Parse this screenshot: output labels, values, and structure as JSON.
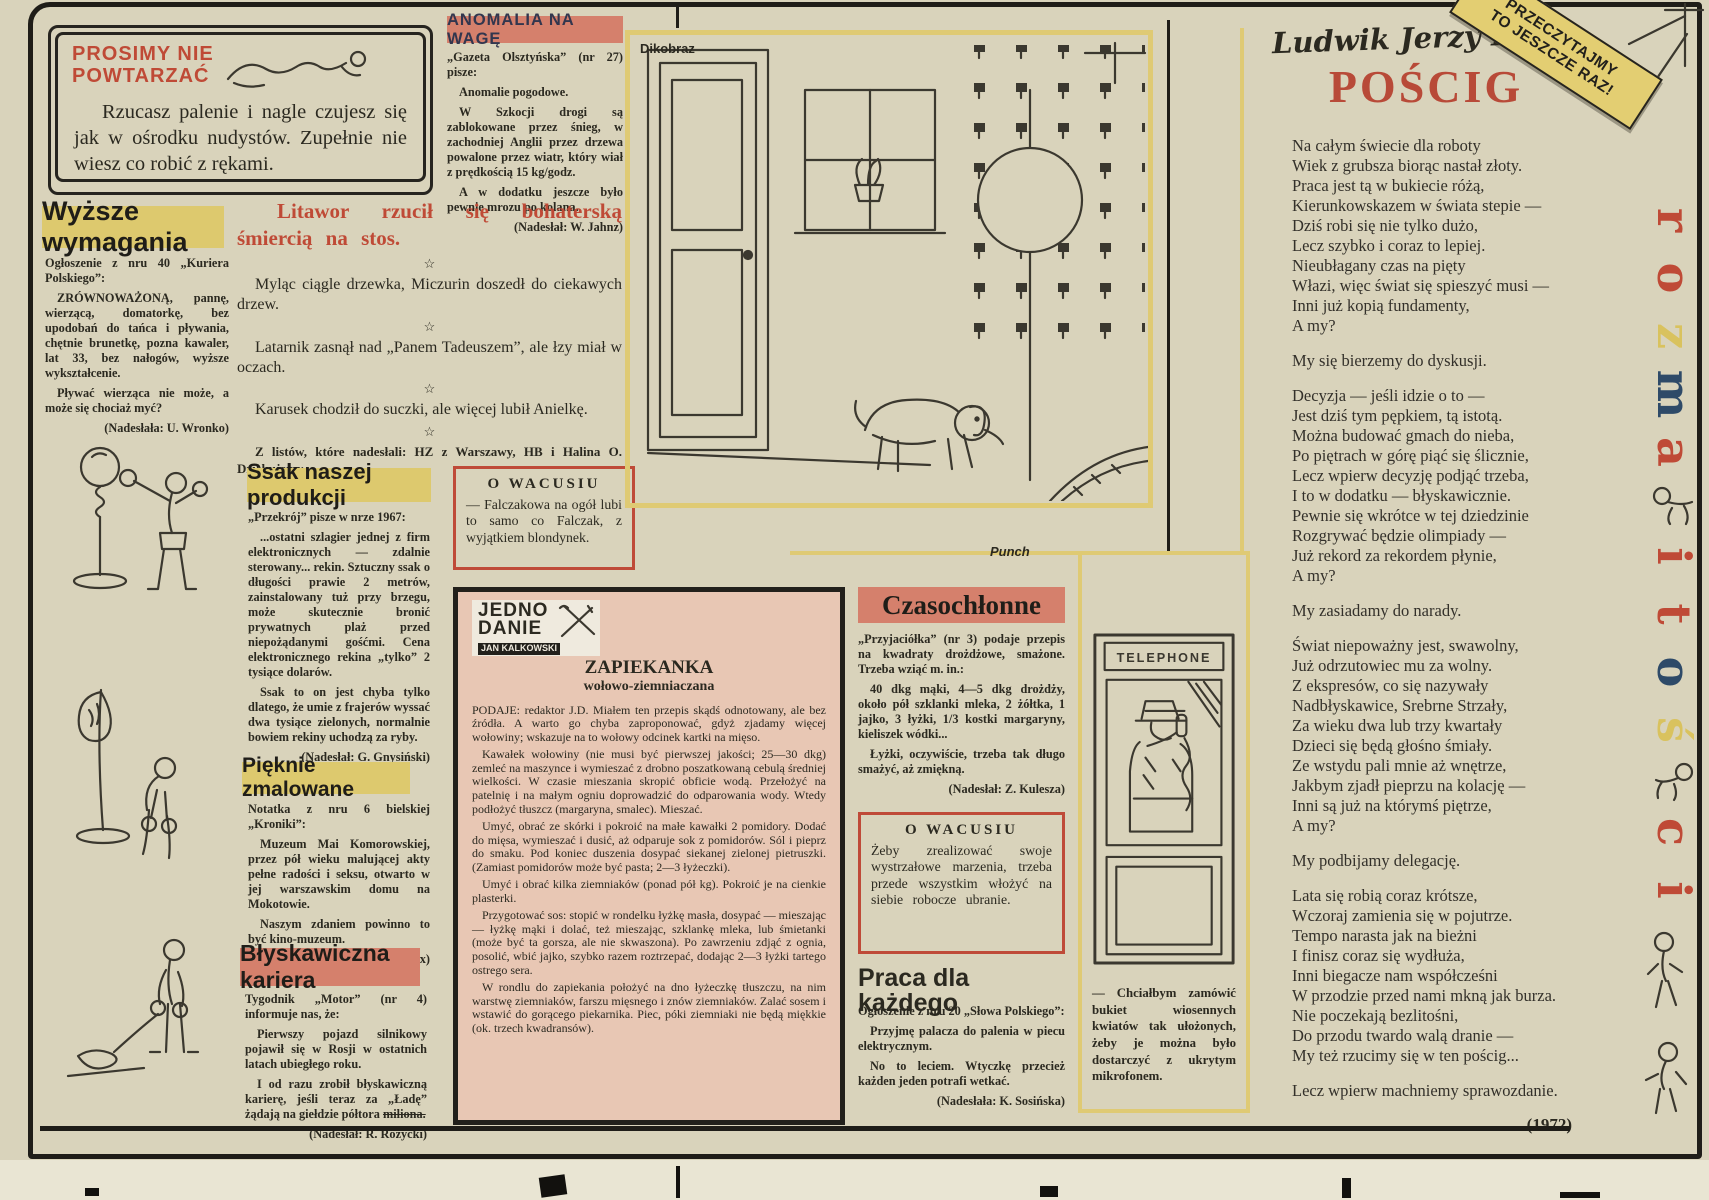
{
  "palette": {
    "paper": "#d9d3bb",
    "ink": "#2b2920",
    "accent_red": "#bf4a36",
    "poem_red": "#b84a38",
    "headline_salmon": "#d5806c",
    "highlight_yellow": "#ddc96e",
    "recipe_pink": "#e8c7b4",
    "navy": "#32364e",
    "frame_yellow": "#dfca74"
  },
  "corner_banner": {
    "text": "PRZECZYTAJMY\nTO JESZCZE RAZ!"
  },
  "no_repeat_box": {
    "title": "PROSIMY NIE\nPOWTARZAĆ",
    "body": "Rzucasz palenie i nagle czujesz się jak w ośrodku nudystów. Zupełnie nie wiesz co robić z rękami."
  },
  "wyzsze_wymagania": {
    "title": "Wyższe wymagania",
    "paragraphs": [
      "Ogłoszenie z nru 40 „Kuriera Polskiego”:",
      "ZRÓWNOWAŻONĄ, pannę, wierzącą, domatorkę, bez upodobań do tańca i pływania, chętnie brunetkę, pozna kawaler, lat 33, bez nałogów, wyższe wykształcenie.",
      "Pływać wierząca nie może, a może się chociaż myć?"
    ],
    "credit": "(Nadesłała: U. Wronko)"
  },
  "anomalia": {
    "title": "ANOMALIA NA WAGĘ",
    "paragraphs": [
      "„Gazeta Olsztyńska” (nr 27) pisze:",
      "Anomalie pogodowe.",
      "W Szkocji drogi są zablokowane przez śnieg, w zachodniej Anglii przez drzewa powalone przez wiatr, który wiał z prędkością 15 kg/godz.",
      "A w dodatku jeszcze było pewnie mrozu po kolana."
    ],
    "credit": "(Nadesłał: W. Jahnz)"
  },
  "litawor": {
    "headline": "Litawor rzucił się bohaterską śmiercią na stos.",
    "star": "☆",
    "aphorisms": [
      "Myląc ciągle drzewka, Miczurin doszedł do ciekawych drzew.",
      "Latarnik zasnął nad „Panem Tadeuszem”, ale łzy miał w oczach.",
      "Karusek chodził do suczki, ale więcej lubił Anielkę."
    ],
    "letters_note": "Z listów, które nadesłali: HZ z Warszawy, HB i Halina O. Dziękujemy."
  },
  "ssak": {
    "title": "Ssak naszej produkcji",
    "paragraphs": [
      "„Przekrój” pisze w nrze 1967:",
      "...ostatni szlagier jednej z firm elektronicznych — zdalnie sterowany... rekin. Sztuczny ssak o długości prawie 2 metrów, zainstalowany tuż przy brzegu, może skutecznie bronić prywatnych plaż przed niepożądanymi gośćmi. Cena elektronicznego rekina „tylko” 2 tysiące dolarów.",
      "Ssak to on jest chyba tylko dlatego, że umie z frajerów wyssać dwa tysiące zielonych, normalnie bowiem rekiny uchodzą za ryby."
    ],
    "credit": "(Nadesłał: G. Gnysiński)"
  },
  "pieknie": {
    "title": "Pięknie zmalowane",
    "paragraphs": [
      "Notatka z nru 6 bielskiej „Kroniki”:",
      "Muzeum Mai Komorowskiej, przez pół wieku malującej akty pełne radości i seksu, otwarto w jej warszawskim domu na Mokotowie.",
      "Naszym zdaniem powinno to być kino-muzeum."
    ],
    "credit": "(Nadesłał: W. Fox)"
  },
  "blyskawiczna": {
    "title": "Błyskawiczna kariera",
    "paragraphs": [
      "Tygodnik „Motor” (nr 4) informuje nas, że:",
      "Pierwszy pojazd silnikowy pojawił się w Rosji w ostatnich latach ubiegłego roku.",
      "I od razu zrobił błyskawiczną karierę, jeśli teraz za „Ładę” żądają na giełdzie półtora"
    ],
    "strike_word": "miliona.",
    "credit": "(Nadesłał: R. Różycki)"
  },
  "wacusiu1": {
    "title": "O WACUSIU",
    "body": "— Falczakowa na ogół lubi to samo co Falczak, z wyjątkiem blondynek."
  },
  "zapiekanka": {
    "logo_line1": "JEDNO",
    "logo_line2": "DANIE",
    "logo_byline": "JAN KALKOWSKI",
    "title": "ZAPIEKANKA",
    "subtitle": "wołowo-ziemniaczana",
    "paragraphs": [
      "PODAJE: redaktor J.D. Miałem ten przepis skądś odnotowany, ale bez źródła. A warto go chyba zaproponować, gdyż zjadamy więcej wołowiny; wskazuje na to wołowy odcinek kartki na mięso.",
      "Kawałek wołowiny (nie musi być pierwszej jakości; 25—30 dkg) zemleć na maszynce i wymieszać z drobno poszatkowaną cebulą średniej wielkości. W czasie mieszania skropić obficie wodą. Przełożyć na patelnię i na małym ogniu doprowadzić do odparowania wody. Wtedy podłożyć tłuszcz (margaryna, smalec). Mieszać.",
      "Umyć, obrać ze skórki i pokroić na małe kawałki 2 pomidory. Dodać do mięsa, wymieszać i dusić, aż odparuje sok z pomidorów. Sól i pieprz do smaku. Pod koniec duszenia dosypać siekanej zielonej pietruszki. (Zamiast pomidorów może być pasta; 2—3 łyżeczki).",
      "Umyć i obrać kilka ziemniaków (ponad pół kg). Pokroić je na cienkie plasterki.",
      "Przygotować sos: stopić w rondelku łyżkę masła, dosypać — mieszając — łyżkę mąki i dolać, też mieszając, szklankę mleka, lub śmietanki (może być ta gorsza, ale nie skwaszona). Po zawrzeniu zdjąć z ognia, posolić, wbić jajko, szybko razem roztrzepać, dodając 2—3 łyżki tartego ostrego sera.",
      "W rondlu do zapiekania położyć na dno łyżeczkę tłuszczu, na nim warstwę ziemniaków, farszu mięsnego i znów ziemniaków. Zalać sosem i wstawić do gorącego piekarnika. Piec, póki ziemniaki nie będą miękkie (ok. trzech kwadransów)."
    ]
  },
  "czasochlonne": {
    "title": "Czasochłonne",
    "paragraphs": [
      "„Przyjaciółka” (nr 3) podaje przepis na kwadraty drożdżowe, smażone. Trzeba wziąć m. in.:",
      "40 dkg mąki, 4—5 dkg drożdży, około pół szklanki mleka, 2 żółtka, 1 jajko, 3 łyżki, 1/3 kostki margaryny, kieliszek wódki...",
      "Łyżki, oczywiście, trzeba tak długo smażyć, aż zmiękną."
    ],
    "credit": "(Nadesłał: Z. Kulesza)"
  },
  "wacusiu2": {
    "title": "O WACUSIU",
    "body": "Żeby zrealizować swoje wystrzałowe marzenia, trzeba przede wszystkim włożyć na siebie robocze ubranie."
  },
  "praca": {
    "title": "Praca dla każdego",
    "paragraphs": [
      "Ogłoszenie z nru 20 „Słowa Polskiego”:",
      "Przyjmę palacza do palenia w piecu elektrycznym.",
      "No to leciem. Wtyczkę przecież każden jeden potrafi wetkać."
    ],
    "credit": "(Nadesłała: K. Sosińska)"
  },
  "dikobraz": {
    "label": "Dikobraz"
  },
  "punch": {
    "label": "Punch",
    "sign": "TELEPHONE",
    "caption": "— Chciałbym zamówić bukiet wiosennych kwiatów tak ułożonych, żeby je można było dostarczyć z ukrytym mikrofonem."
  },
  "poem": {
    "author": "Ludwik Jerzy Kern",
    "title": "POŚCIG",
    "stanzas": [
      [
        "Na całym świecie dla roboty",
        "Wiek z grubsza biorąc nastał złoty.",
        "Praca jest tą w bukiecie różą,",
        "Kierunkowskazem w świata stepie —",
        "Dziś robi się nie tylko dużo,",
        "Lecz szybko i coraz to lepiej.",
        "Nieubłagany czas na pięty",
        "Włazi, więc świat się spieszyć musi —",
        "Inni już kopią fundamenty,",
        "A my?"
      ],
      [
        "My się bierzemy do dyskusji."
      ],
      [
        "Decyzja — jeśli idzie o to —",
        "Jest dziś tym pępkiem, tą istotą.",
        "Można budować gmach do nieba,",
        "Po piętrach w górę piąć się ślicznie,",
        "Lecz wpierw decyzję podjąć trzeba,",
        "I to w dodatku — błyskawicznie.",
        "Pewnie się wkrótce w tej dziedzinie",
        "Rozgrywać będzie olimpiady —",
        "Już rekord za rekordem płynie,",
        "A my?"
      ],
      [
        "My zasiadamy do narady."
      ],
      [
        "Świat niepoważny jest, swawolny,",
        "Już odrzutowiec mu za wolny.",
        "Z ekspresów, co się nazywały",
        "Nadbłyskawice, Srebrne Strzały,",
        "Za wieku dwa lub trzy kwartały",
        "Dzieci się będą głośno śmiały.",
        "Ze wstydu pali mnie aż wnętrze,",
        "Jakbym zjadł pieprzu na kolację —",
        "Inni są już na którymś piętrze,",
        "A my?"
      ],
      [
        "My podbijamy delegację."
      ],
      [
        "Lata się robią coraz krótsze,",
        "Wczoraj zamienia się w pojutrze.",
        "Tempo narasta jak na bieżni",
        "I finisz coraz się wydłuża,",
        "Inni biegacze nam współcześni",
        "W przodzie przed nami mkną jak burza.",
        "Nie poczekają bezlitośni,",
        "Do przodu twardo walą dranie —",
        "My też rzucimy się w ten pościg..."
      ],
      [
        "Lecz wpierw machniemy sprawozdanie."
      ]
    ],
    "year": "(1972)"
  },
  "vertical_title": {
    "letters": [
      {
        "ch": "r",
        "color": "#bf4a36"
      },
      {
        "ch": "o",
        "color": "#bf4a36"
      },
      {
        "ch": "z",
        "color": "#d9c25e"
      },
      {
        "ch": "m",
        "color": "#2e4a68"
      },
      {
        "ch": "a",
        "color": "#bf4a36"
      },
      {
        "ch": "i",
        "color": "#bf4a36"
      },
      {
        "ch": "t",
        "color": "#bf4a36"
      },
      {
        "ch": "o",
        "color": "#2e4a68"
      },
      {
        "ch": "ś",
        "color": "#d9c25e"
      },
      {
        "ch": "c",
        "color": "#bf4a36"
      },
      {
        "ch": "i",
        "color": "#bf4a36"
      }
    ]
  }
}
